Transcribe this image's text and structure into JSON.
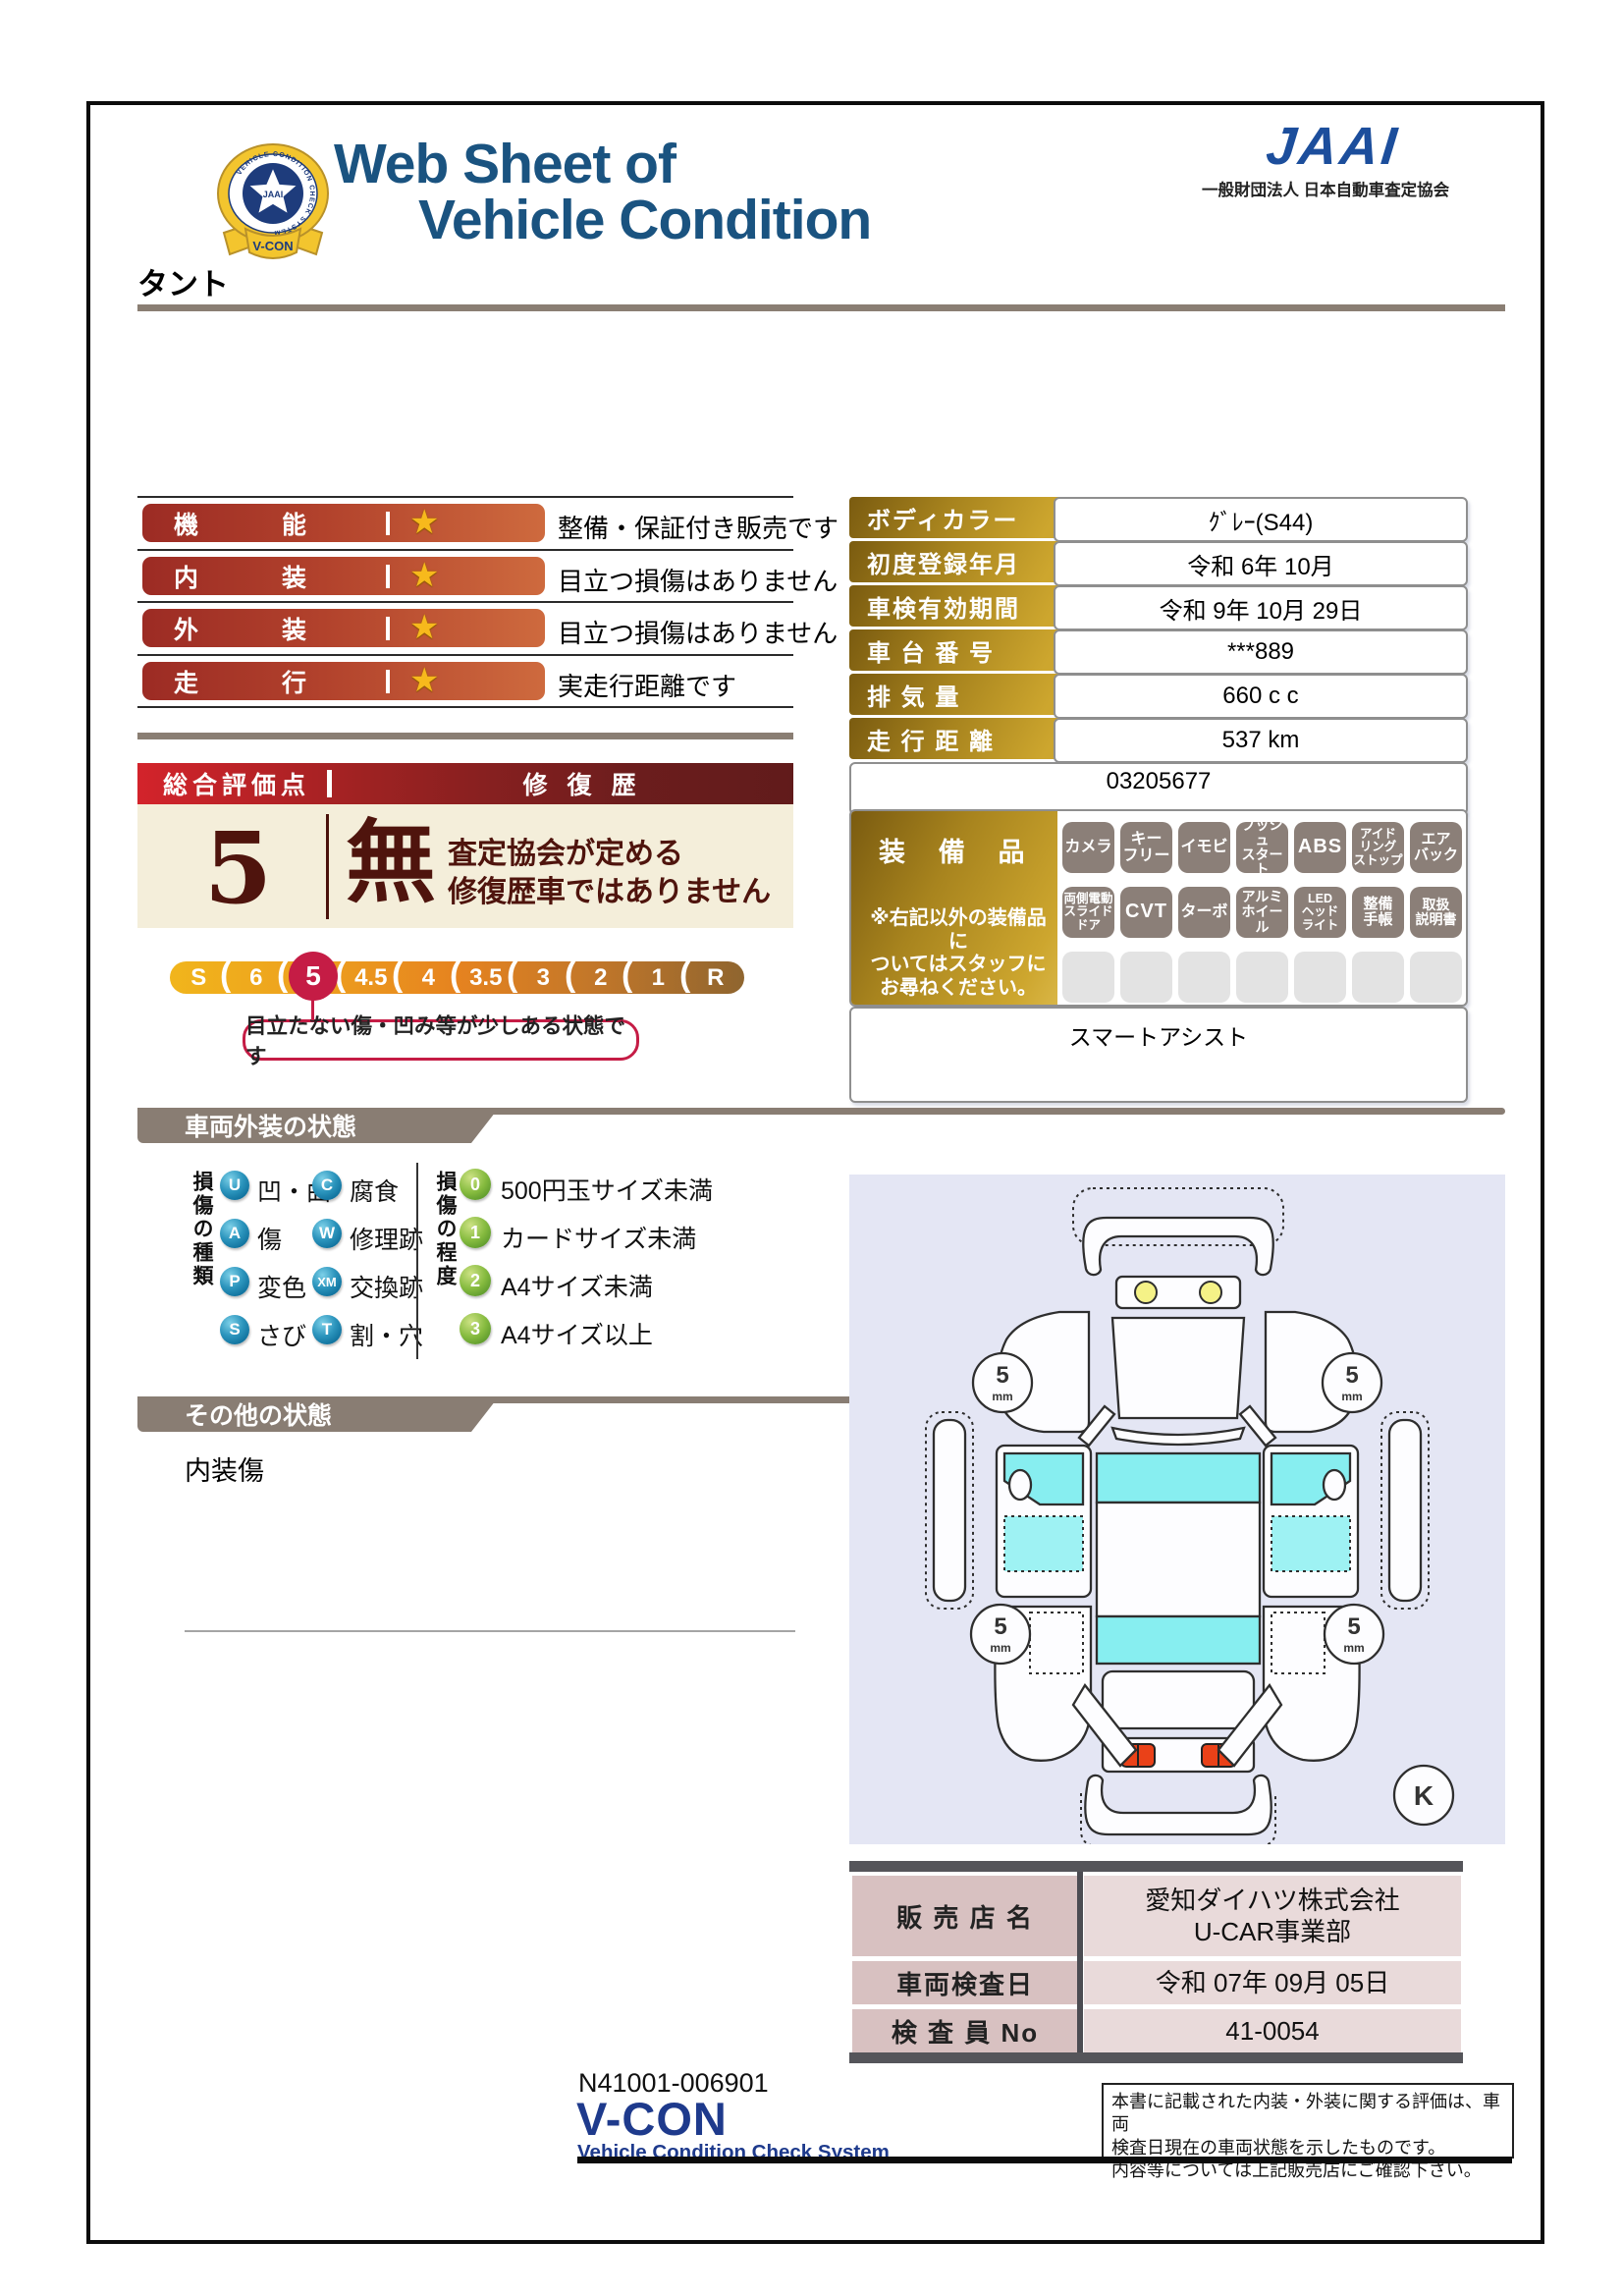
{
  "header": {
    "title1": "Web Sheet of",
    "title2": "Vehicle Condition",
    "badge": {
      "star_label": "JAAI",
      "ribbon": "V-CON",
      "ring": "VEHICLE CONDITION CHECK SYSTEM"
    },
    "org_mark": "JAAI",
    "org_name": "一般財団法人 日本自動車査定協会"
  },
  "vehicle": {
    "name": "タント"
  },
  "ratings": {
    "rows": [
      {
        "label": "機能",
        "star": "★",
        "desc": "整備・保証付き販売です"
      },
      {
        "label": "内装",
        "star": "★",
        "desc": "目立つ損傷はありません"
      },
      {
        "label": "外装",
        "star": "★",
        "desc": "目立つ損傷はありません"
      },
      {
        "label": "走行",
        "star": "★",
        "desc": "実走行距離です"
      }
    ]
  },
  "info": {
    "rows": [
      {
        "label": "ボディカラー",
        "value": "ｸﾞﾚｰ(S44)"
      },
      {
        "label": "初度登録年月",
        "value": "令和 6年 10月"
      },
      {
        "label": "車検有効期間",
        "value": "令和 9年 10月 29日"
      },
      {
        "label": "車 台 番 号",
        "value": "***889"
      },
      {
        "label": "排  気  量",
        "value": "660 c c"
      },
      {
        "label": "走 行 距 離",
        "value": "537 km"
      }
    ],
    "ref_number": "03205677"
  },
  "score": {
    "header_left": "総合評価点",
    "header_right": "修復歴",
    "value": "5",
    "repair": "無",
    "repair_note": "査定協会が定める\n修復歴車ではありません",
    "scale": [
      "S",
      "6",
      "5",
      "4.5",
      "4",
      "3.5",
      "3",
      "2",
      "1",
      "R"
    ],
    "selected": "5",
    "separator": "(",
    "callout": "目立たない傷・凹み等が少しある状態です"
  },
  "equipment": {
    "label": "装備品",
    "note": "※右記以外の装備品に\nついてはスタッフに\nお尋ねください。",
    "items": [
      "カメラ",
      "キー\nフリー",
      "イモビ",
      "プッシュ\nスタート",
      "ABS",
      "アイド\nリング\nストップ",
      "エア\nバック",
      "両側電動\nスライド\nドア",
      "CVT",
      "ターボ",
      "アルミ\nホイール",
      "LED\nヘッド\nライト",
      "整備\n手帳",
      "取扱\n説明書"
    ],
    "extra": "スマートアシスト"
  },
  "exterior": {
    "banner": "車両外装の状態",
    "type_title": "損傷の種類",
    "types": [
      {
        "code": "U",
        "label": "凹・曲"
      },
      {
        "code": "A",
        "label": "傷"
      },
      {
        "code": "P",
        "label": "変色"
      },
      {
        "code": "S",
        "label": "さび"
      },
      {
        "code": "C",
        "label": "腐食"
      },
      {
        "code": "W",
        "label": "修理跡"
      },
      {
        "code": "XM",
        "label": "交換跡"
      },
      {
        "code": "T",
        "label": "割・穴"
      }
    ],
    "degree_title": "損傷の程度",
    "degrees": [
      {
        "code": "0",
        "label": "500円玉サイズ未満"
      },
      {
        "code": "1",
        "label": "カードサイズ未満"
      },
      {
        "code": "2",
        "label": "A4サイズ未満"
      },
      {
        "code": "3",
        "label": "A4サイズ以上"
      }
    ]
  },
  "other": {
    "banner": "その他の状態",
    "note": "内装傷"
  },
  "diagram": {
    "tire_size": "5",
    "tire_unit": "mm",
    "key_mark": "K"
  },
  "dealer": {
    "rows": [
      {
        "label": "販 売 店 名",
        "value": "愛知ダイハツ株式会社\nU-CAR事業部"
      },
      {
        "label": "車両検査日",
        "value": "令和 07年 09月 05日"
      },
      {
        "label": "検 査 員 No",
        "value": "41-0054"
      }
    ]
  },
  "footer": {
    "doc_number": "N41001-006901",
    "vcon": "V-CON",
    "vcon_sub": "Vehicle Condition Check System",
    "disclaimer": "本書に記載された内装・外装に関する評価は、車両\n検査日現在の車両状態を示したものです。\n内容等については上記販売店にご確認下さい。"
  },
  "colors": {
    "title_blue": "#1a5380",
    "jaai_blue": "#1c4e9c",
    "pill_red": "#9c2b24",
    "pill_orange": "#ce6a3e",
    "gold_dark": "#7a5b10",
    "gold_light": "#cda62e",
    "maroon": "#4f140d",
    "crimson": "#c51c45",
    "banner_gray": "#897d73",
    "window_cyan": "#87eef0",
    "diagram_bg": "#e4e6f4",
    "table_pink": "#d8c1c1"
  }
}
